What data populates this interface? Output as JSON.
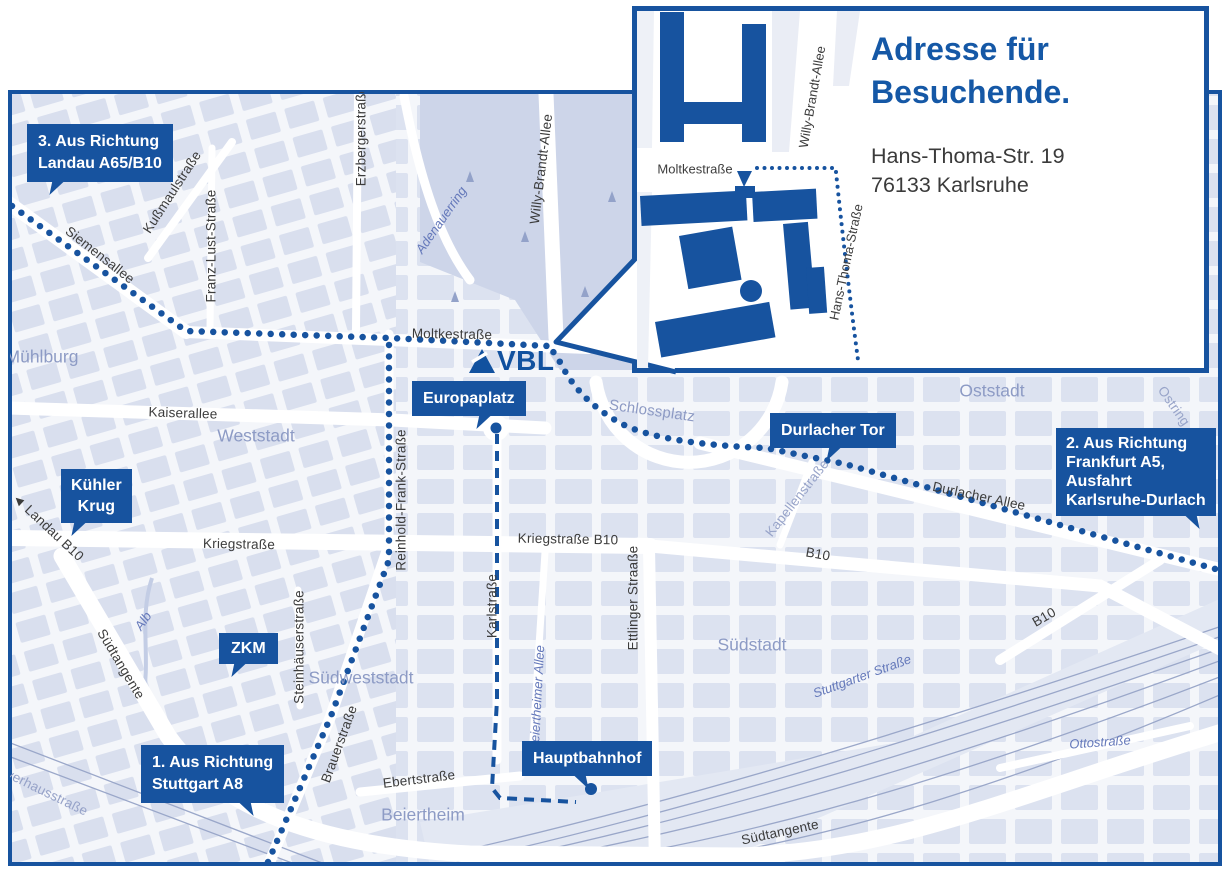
{
  "colors": {
    "brand_blue": "#17539f",
    "heading_blue": "#1558a6",
    "street_text": "#3c3c3c",
    "area_text": "#8d9bc5",
    "water_text": "#6478ba",
    "map_block": "#dce2f0"
  },
  "logo": {
    "text": "VBL"
  },
  "inset": {
    "title": [
      "Adresse für",
      "Besuchende."
    ],
    "address": [
      "Hans-Thoma-Str. 19",
      "76133 Karlsruhe"
    ],
    "streets": [
      "Moltkestraße",
      "Willy-Brandt-Allee",
      "Hans-Thoma-Straße"
    ]
  },
  "callouts": [
    {
      "id": "landau",
      "lines": [
        "3. Aus Richtung",
        "Landau A65/B10"
      ]
    },
    {
      "id": "frankfurt",
      "lines": [
        "2. Aus Richtung",
        "Frankfurt A5,",
        "Ausfahrt",
        "Karlsruhe-Durlach"
      ]
    },
    {
      "id": "stuttgart",
      "lines": [
        "1. Aus Richtung",
        "Stuttgart A8"
      ]
    },
    {
      "id": "kuehler-krug",
      "lines": [
        "Kühler",
        "Krug"
      ]
    },
    {
      "id": "zkm",
      "lines": [
        "ZKM"
      ]
    },
    {
      "id": "europaplatz",
      "lines": [
        "Europaplatz"
      ]
    },
    {
      "id": "durlacher-tor",
      "lines": [
        "Durlacher Tor"
      ]
    },
    {
      "id": "hauptbahnhof",
      "lines": [
        "Hauptbahnhof"
      ]
    }
  ],
  "street_labels": [
    "Siemensallee",
    "Kußmaulstraße",
    "Franz-Lust-Straße",
    "Erzbergerstraße",
    "Moltkestraße",
    "Willy-Brandt-Allee",
    "Kaiserallee",
    "Durlacher Allee",
    "B10",
    "B10",
    "Kriegstraße",
    "Kriegstraße B10",
    "Reinhold-Frank-Straße",
    "Karlstraße",
    "Ettlinger Straaße",
    "Steinhäuserstraße",
    "Südtangente",
    "Südtangente",
    "Brauerstraße",
    "Ebertstraße",
    "◄ Landau B10",
    "Pulverhausstraße",
    "Kapellenstraße",
    "Ostring",
    "Schlossplatz",
    "Adenauerring",
    "Beiertheimer Allee",
    "Alb",
    "Stuttgarter Straße",
    "Ottostraße"
  ],
  "area_labels": [
    "Mühlburg",
    "Weststadt",
    "Oststadt",
    "Südstadt",
    "Südweststadt",
    "Beiertheim"
  ]
}
